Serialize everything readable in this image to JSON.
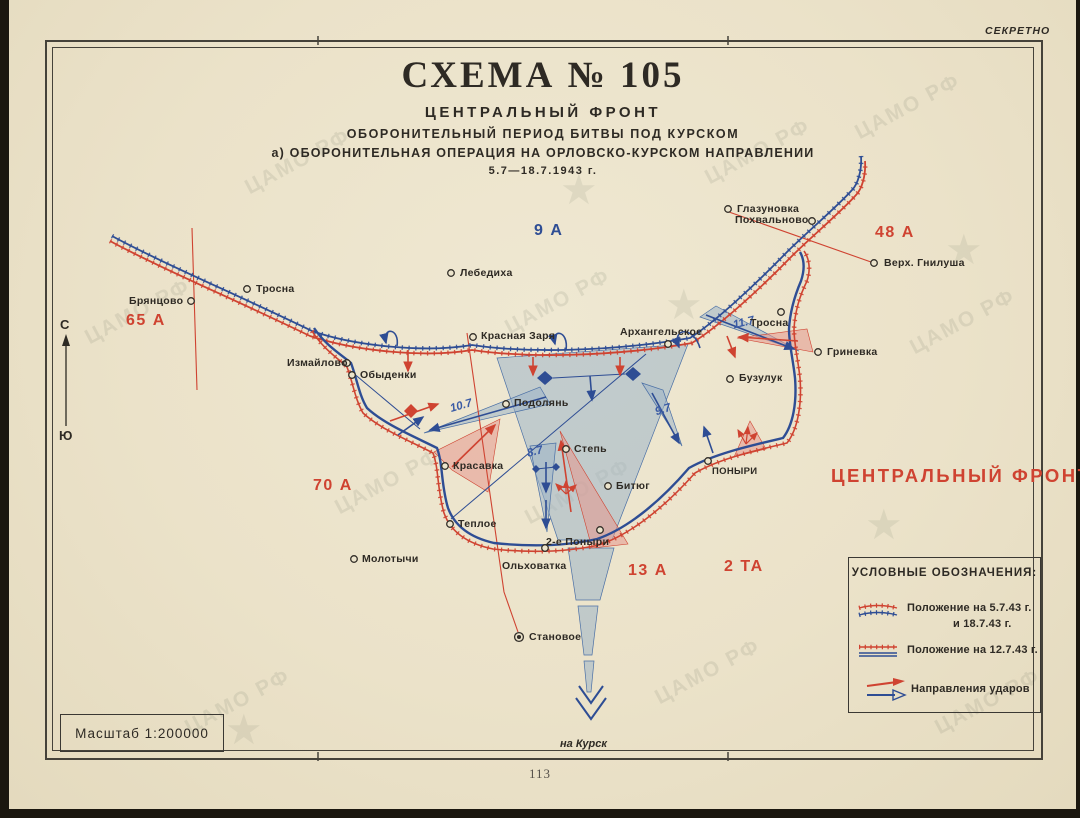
{
  "classification": "СЕКРЕТНО",
  "title": {
    "main": "СХЕМА № 105",
    "line1": "ЦЕНТРАЛЬНЫЙ ФРОНТ",
    "line2": "ОБОРОНИТЕЛЬНЫЙ ПЕРИОД БИТВЫ ПОД КУРСКОМ",
    "line3": "а) ОБОРОНИТЕЛЬНАЯ ОПЕРАЦИЯ НА ОРЛОВСКО-КУРСКОМ НАПРАВЛЕНИИ",
    "line4": "5.7—18.7.1943 г."
  },
  "compass": {
    "north": "С",
    "south": "Ю"
  },
  "front_label": "ЦЕНТРАЛЬНЫЙ ФРОНТ",
  "armies": [
    {
      "label": "9 А",
      "color": "blue"
    },
    {
      "label": "48 А",
      "color": "red"
    },
    {
      "label": "65 А",
      "color": "red"
    },
    {
      "label": "70 А",
      "color": "red"
    },
    {
      "label": "13 А",
      "color": "red"
    },
    {
      "label": "2 ТА",
      "color": "red"
    }
  ],
  "towns": [
    {
      "name": "Глазуновка"
    },
    {
      "name": "Похвальново"
    },
    {
      "name": "Верх. Гнилуша"
    },
    {
      "name": "Тросна"
    },
    {
      "name": "Брянцово"
    },
    {
      "name": "Лебедиха"
    },
    {
      "name": "Красная Заря"
    },
    {
      "name": "Архангельское"
    },
    {
      "name": "Измайлово"
    },
    {
      "name": "Обыденки"
    },
    {
      "name": "Подолянь"
    },
    {
      "name": "Бузулук"
    },
    {
      "name": "Тросна"
    },
    {
      "name": "Гриневка"
    },
    {
      "name": "Степь"
    },
    {
      "name": "Красавка"
    },
    {
      "name": "Битюг"
    },
    {
      "name": "ПОНЫРИ"
    },
    {
      "name": "Теплое"
    },
    {
      "name": "Молотычи"
    },
    {
      "name": "Ольховатка"
    },
    {
      "name": "2-е Поныри"
    },
    {
      "name": "Становое"
    }
  ],
  "date_marks": [
    "10.7",
    "8.7",
    "9.7",
    "11.7"
  ],
  "route_label": "на Курск",
  "legend": {
    "title": "УСЛОВНЫЕ ОБОЗНАЧЕНИЯ:",
    "items": [
      {
        "label": "Положение на 5.7.43 г.",
        "label2": "и 18.7.43 г."
      },
      {
        "label": "Положение на 12.7.43 г."
      },
      {
        "label": "Направления ударов"
      }
    ]
  },
  "scale_label": "Масштаб 1:200000",
  "page_number": "113",
  "watermark": {
    "text": "ЦАМО РФ"
  },
  "colors": {
    "red": "#cf4331",
    "blue": "#2e4d94",
    "light_blue": "#9db4c9",
    "pink": "#e5988e",
    "paper": "#ebe2c9"
  }
}
